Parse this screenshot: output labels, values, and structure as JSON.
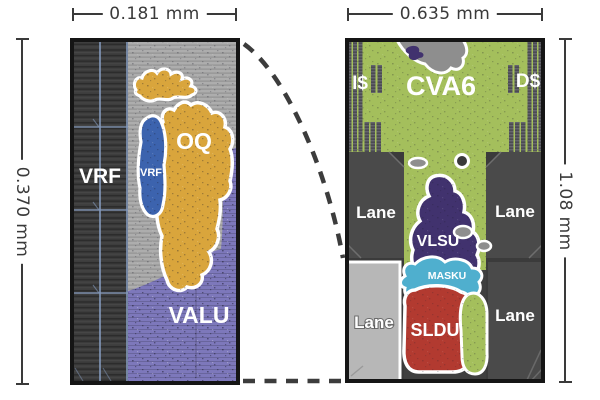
{
  "left": {
    "width": "0.181 mm",
    "height": "0.370 mm",
    "regions": {
      "vrf": "VRF",
      "vrf_small": "VRF",
      "oq": "OQ",
      "valu": "VALU"
    }
  },
  "right": {
    "width": "0.635 mm",
    "height": "1.08 mm",
    "regions": {
      "icache": "I$",
      "cva6": "CVA6",
      "dcache": "D$",
      "lane": "Lane",
      "vlsu": "VLSU",
      "masku": "MASKU",
      "sldu": "SLDU"
    }
  },
  "colors": {
    "dim": "#3a3a3a",
    "dash": "#3c3c3c",
    "die_border": "#151515",
    "vrf_dark": "#3d3d3d",
    "grid_blue": "#8ba3c9",
    "silicon_gray": "#adadad",
    "valu_purple": "#7d78bb",
    "oq_orange": "#d9a53c",
    "vrf_blue": "#3c63ae",
    "cva6_green": "#a4bf5c",
    "lane_dark": "#4a4a4a",
    "lane_light": "#b7b7b7",
    "vlsu_indigo": "#41326e",
    "masku_cyan": "#4fafce",
    "sldu_red": "#b23a30",
    "blob_gray": "#8e8e8e",
    "outline": "#ffffff"
  }
}
